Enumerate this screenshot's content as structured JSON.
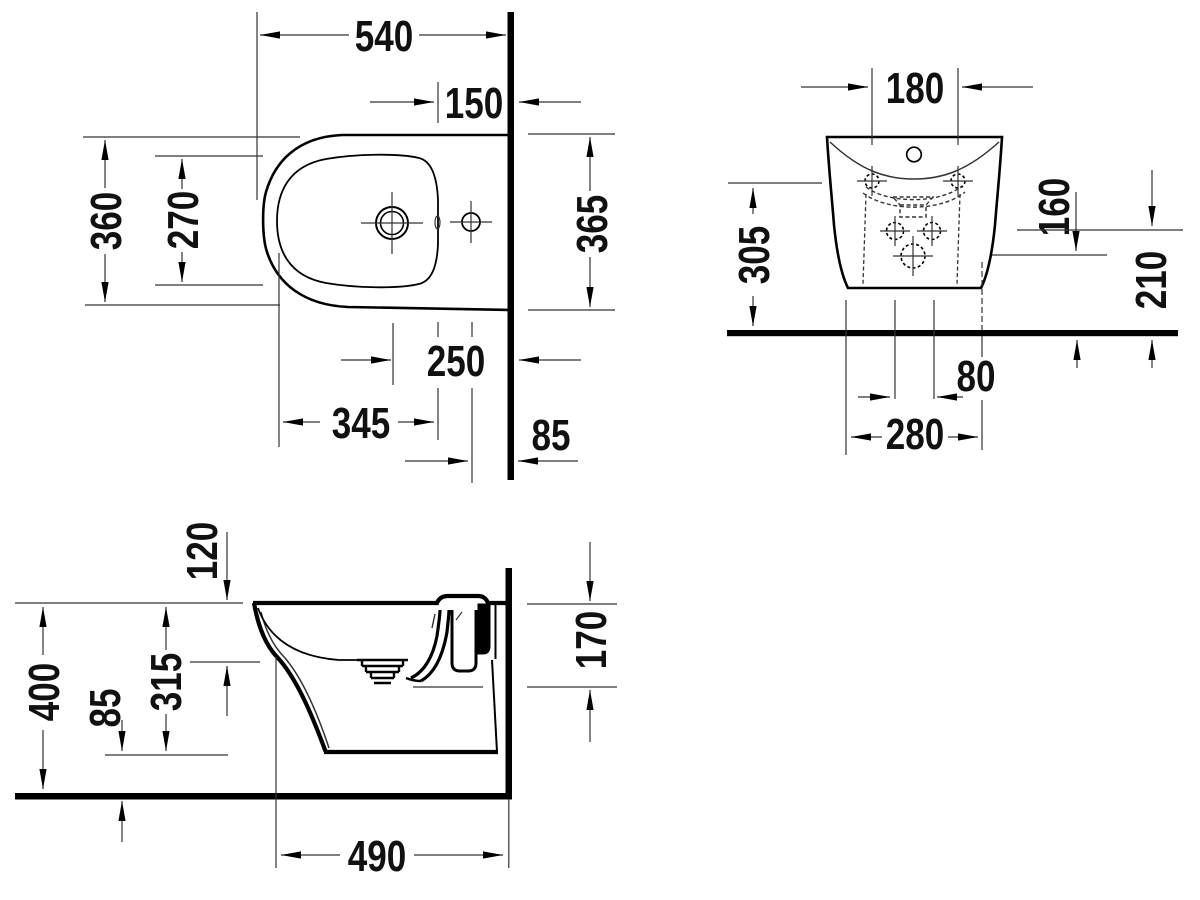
{
  "drawing": {
    "plan": {
      "overall_depth": "540",
      "rim_to_wall": "150",
      "overall_width": "360",
      "bowl_inner_width": "270",
      "width_at_wall": "365",
      "drain_center_to_wall": "250",
      "bowl_inner_length": "345",
      "tap_center_to_wall": "85"
    },
    "front": {
      "tap_holes_spacing": "180",
      "upper_holes_height": "305",
      "lower_hole_height": "160",
      "mid_holes_height": "210",
      "mid_holes_spacing": "80",
      "base_width": "280"
    },
    "side": {
      "rim_depth": "120",
      "overall_height": "400",
      "base_clearance": "85",
      "body_height": "315",
      "outlet_height": "170",
      "body_depth": "490"
    }
  }
}
